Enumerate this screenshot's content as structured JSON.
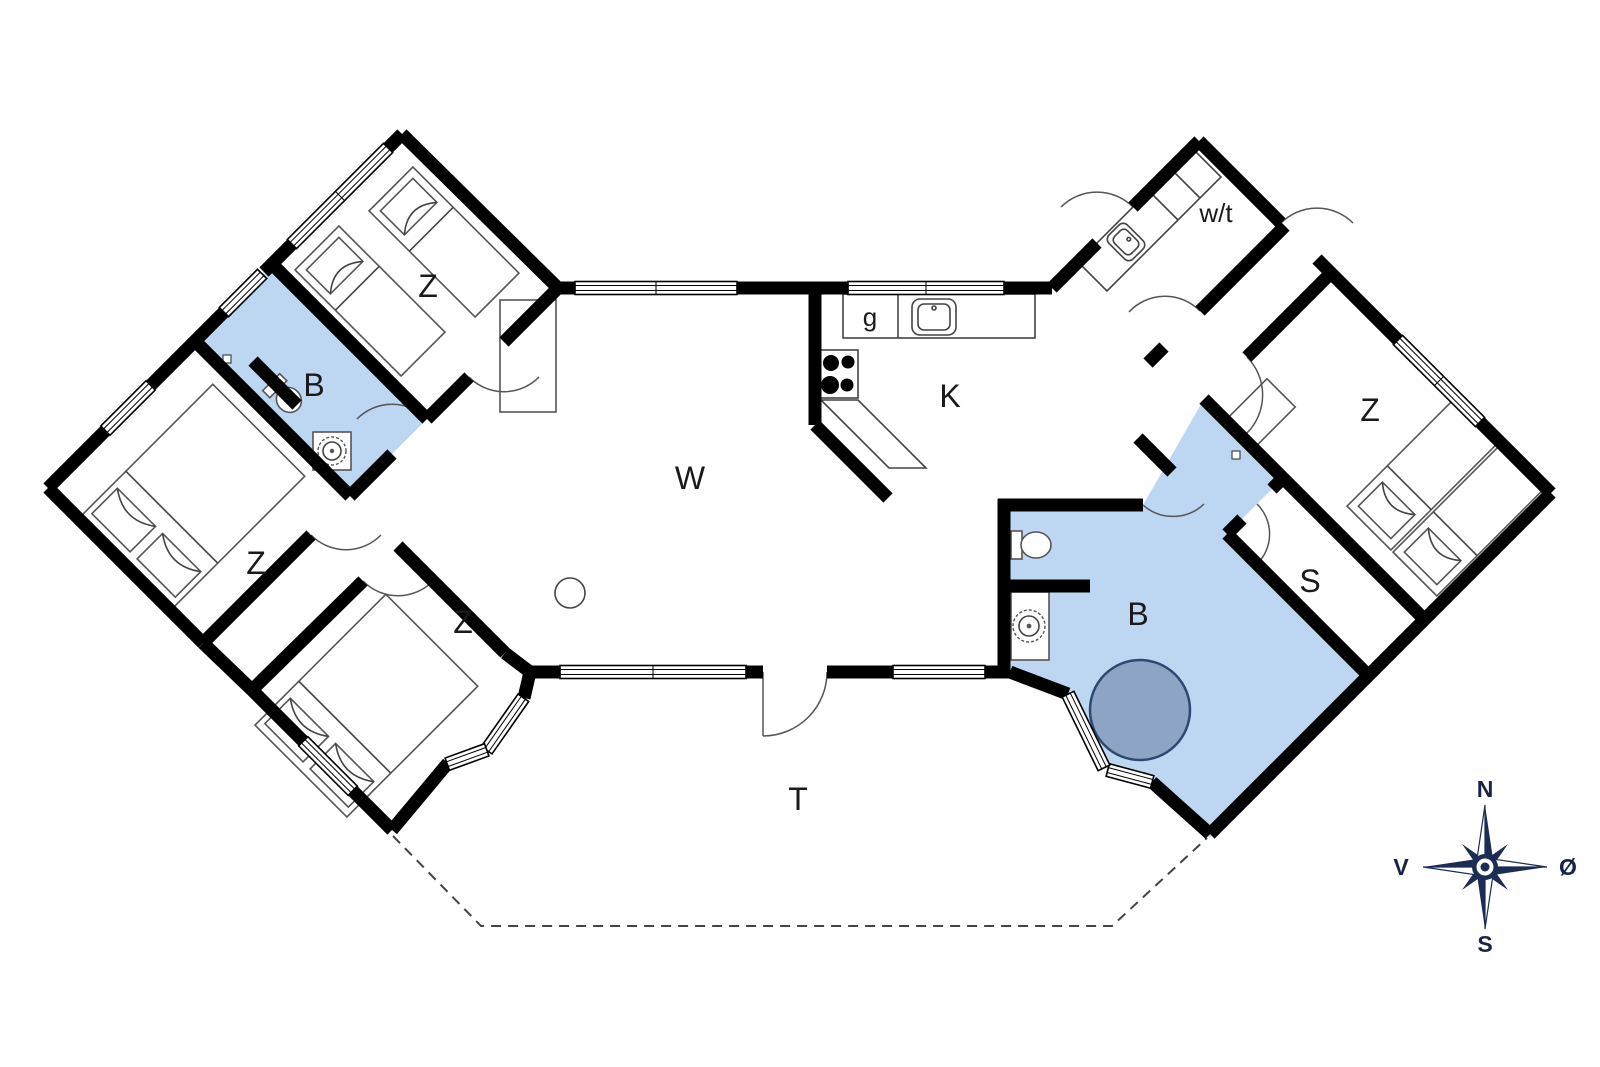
{
  "rooms": [
    {
      "id": "bedroom-top-left",
      "label": "Z"
    },
    {
      "id": "bath-left",
      "label": "B"
    },
    {
      "id": "bedroom-mid-left",
      "label": "Z"
    },
    {
      "id": "bedroom-lower-left",
      "label": "Z"
    },
    {
      "id": "living-room",
      "label": "W"
    },
    {
      "id": "kitchen",
      "label": "K"
    },
    {
      "id": "fridge",
      "label": "g"
    },
    {
      "id": "utility",
      "label": "w/t"
    },
    {
      "id": "bedroom-right",
      "label": "Z"
    },
    {
      "id": "storage",
      "label": "S"
    },
    {
      "id": "bath-right",
      "label": "B"
    },
    {
      "id": "terrace",
      "label": "T"
    }
  ],
  "compass": {
    "n": "N",
    "s": "S",
    "v": "V",
    "o": "Ø"
  },
  "colors": {
    "bath_fill": "#bdd7f3",
    "tub_fill": "#8da4c5",
    "tub_stroke": "#2e4871",
    "wall": "#000000",
    "compass_navy": "#1b2c55"
  }
}
